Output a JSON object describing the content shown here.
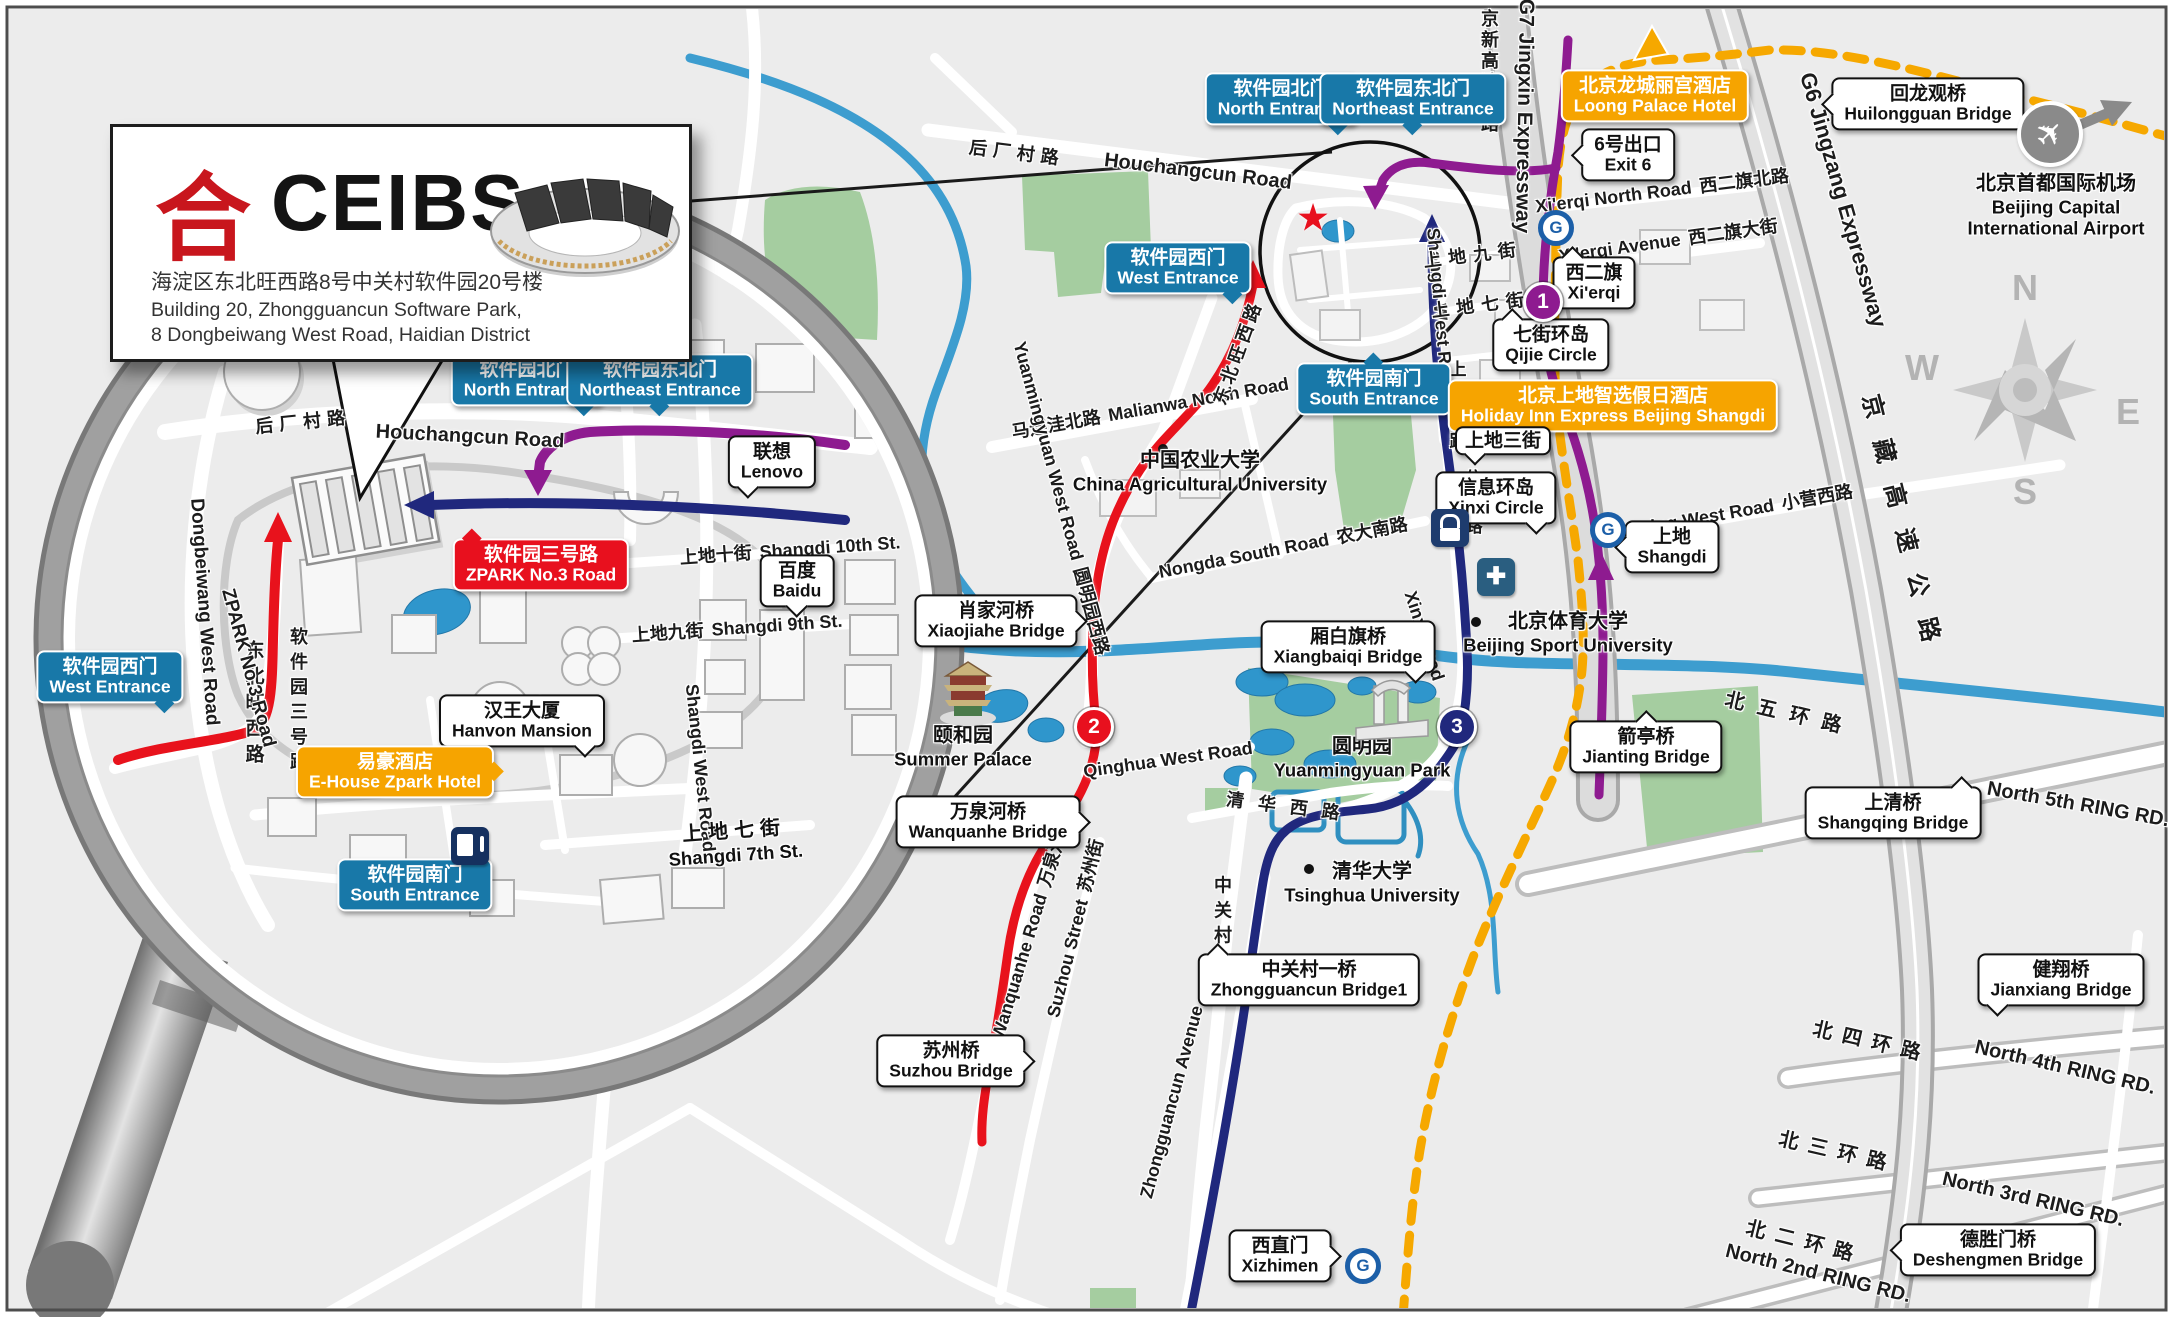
{
  "ceibs": {
    "logo_glyph": "合",
    "name": "CEIBS",
    "address_zh": "海淀区东北旺西路8号中关村软件园20号楼",
    "address_en1": "Building 20, Zhongguancun Software Park,",
    "address_en2": "8 Dongbeiwang West Road, Haidian District"
  },
  "entrances": {
    "north": {
      "zh": "软件园北门",
      "en": "North Entrance"
    },
    "northeast": {
      "zh": "软件园东北门",
      "en": "Northeast Entrance"
    },
    "west": {
      "zh": "软件园西门",
      "en": "West Entrance"
    },
    "south": {
      "zh": "软件园南门",
      "en": "South Entrance"
    }
  },
  "zpark_sign": {
    "zh": "软件园三号路",
    "en": "ZPARK No.3 Road"
  },
  "mag_places": {
    "lenovo": {
      "zh": "联想",
      "en": "Lenovo"
    },
    "baidu": {
      "zh": "百度",
      "en": "Baidu"
    },
    "hanvon": {
      "zh": "汉王大厦",
      "en": "Hanvon Mansion"
    },
    "ehouse": {
      "zh": "易豪酒店",
      "en": "E-House Zpark Hotel"
    }
  },
  "mag_roads": {
    "houchangcun": {
      "zh": "后厂村路",
      "en": "Houchangcun Road"
    },
    "dongbeiwang": {
      "en": "Dongbeiwang West Road",
      "zh": "东北旺西路"
    },
    "zpark3": {
      "en": "ZPARK No.3 Road",
      "zh": "软件园三号路"
    },
    "shangdi10": {
      "zh": "上地十街",
      "en": "Shangdi 10th St."
    },
    "shangdi9": {
      "zh": "上地九街",
      "en": "Shangdi 9th St."
    },
    "shangdi7": {
      "zh": "上地七街",
      "en": "Shangdi 7th St."
    },
    "shangdi_west": {
      "en": "Shangdi West Road"
    }
  },
  "hotels": {
    "loong": {
      "zh": "北京龙城丽宫酒店",
      "en": "Loong Palace Hotel"
    },
    "holiday": {
      "zh": "北京上地智选假日酒店",
      "en": "Holiday Inn Express Beijing Shangdi"
    }
  },
  "callouts": {
    "exit6": {
      "zh": "6号出口",
      "en": "Exit 6"
    },
    "xierqi": {
      "zh": "西二旗",
      "en": "Xi'erqi"
    },
    "qijie": {
      "zh": "七街环岛",
      "en": "Qijie Circle"
    },
    "xinxi": {
      "zh": "信息环岛",
      "en": "Xinxi Circle"
    },
    "shangdi_stn": {
      "zh": "上地",
      "en": "Shangdi"
    },
    "huilongguan": {
      "zh": "回龙观桥",
      "en": "Huilongguan Bridge"
    },
    "xiaojiahe": {
      "zh": "肖家河桥",
      "en": "Xiaojiahe Bridge"
    },
    "xiangbaiqi": {
      "zh": "厢白旗桥",
      "en": "Xiangbaiqi Bridge"
    },
    "wanquanhe": {
      "zh": "万泉河桥",
      "en": "Wanquanhe Bridge"
    },
    "suzhou": {
      "zh": "苏州桥",
      "en": "Suzhou Bridge"
    },
    "jianting": {
      "zh": "箭亭桥",
      "en": "Jianting Bridge"
    },
    "shangqing": {
      "zh": "上清桥",
      "en": "Shangqing Bridge"
    },
    "zgc1": {
      "zh": "中关村一桥",
      "en": "Zhongguancun Bridge1"
    },
    "xizhimen": {
      "zh": "西直门",
      "en": "Xizhimen"
    },
    "jianxiang": {
      "zh": "健翔桥",
      "en": "Jianxiang Bridge"
    },
    "deshengmen": {
      "zh": "德胜门桥",
      "en": "Deshengmen Bridge"
    },
    "shangdi3": {
      "zh": "上地三街"
    }
  },
  "landmarks": {
    "cau": {
      "zh": "中国农业大学",
      "en": "China Agricultural University"
    },
    "bsu": {
      "zh": "北京体育大学",
      "en": "Beijing Sport University"
    },
    "tsinghua": {
      "zh": "清华大学",
      "en": "Tsinghua University"
    },
    "summer": {
      "zh": "颐和园",
      "en": "Summer Palace"
    },
    "ymy": {
      "zh": "圆明园",
      "en": "Yuanmingyuan Park"
    },
    "airport": {
      "zh": "北京首都国际机场",
      "en1": "Beijing Capital",
      "en2": "International Airport"
    }
  },
  "roads": {
    "houchangcun": {
      "zh": "后厂村路",
      "en": "Houchangcun Road"
    },
    "malianwa": {
      "zh": "马连洼北路",
      "en": "Malianwa North Road"
    },
    "dongbeiwang": {
      "zh": "东北旺西路"
    },
    "ymy_west": {
      "en": "Yuanmingyuan West Road",
      "zh": "圆明园西路"
    },
    "nongda": {
      "en": "Nongda South Road",
      "zh": "农大南路"
    },
    "qinghua_w": {
      "en": "Qinghua West Road"
    },
    "qinghua_w_zh": {
      "zh": "清华西路"
    },
    "wanquanhe": {
      "en": "Wanquanhe Road",
      "zh": "万泉河路"
    },
    "suzhou_st": {
      "en": "Suzhou Street",
      "zh": "苏州街"
    },
    "zgc_st": {
      "zh": "中关村大街"
    },
    "zgc_ave": {
      "en": "Zhongguancun Avenue"
    },
    "xinxi_rd": {
      "en": "Xinxi Road",
      "zh": "信息路"
    },
    "shangdi_w": {
      "en": "Shangdi West Road",
      "zh": "上地西路"
    },
    "shangdi9": {
      "zh": "上地九街"
    },
    "shangdi7": {
      "zh": "上地七街"
    },
    "xierqi_n": {
      "en": "Xi'erqi North Road",
      "zh": "西二旗北路"
    },
    "xierqi_ave": {
      "en": "Xi'erqi Avenue",
      "zh": "西二旗大街"
    },
    "xiaoying": {
      "en": "Xiaoying West Road",
      "zh": "小营西路"
    }
  },
  "expressways": {
    "g7": {
      "en": "G7 Jingxin Expressway",
      "zh": "京新高速公路"
    },
    "g6": {
      "en": "G6 Jingzang Expressway",
      "zh": "京藏高速公路"
    }
  },
  "rings": {
    "r5": {
      "zh": "北五环路",
      "en": "North 5th RING RD."
    },
    "r4": {
      "zh": "北四环路",
      "en": "North 4th RING RD."
    },
    "r3": {
      "zh": "北三环路",
      "en": "North 3rd RING RD."
    },
    "r2": {
      "zh": "北二环路",
      "en": "North 2nd RING RD."
    }
  },
  "markers": {
    "one": "1",
    "two": "2",
    "three": "3"
  },
  "compass": {
    "n": "N",
    "e": "E",
    "s": "S",
    "w": "W"
  },
  "icons": {
    "subway_logo": "G",
    "hospital_cross": "✚",
    "red_star": "★",
    "airplane": "✈"
  },
  "colors": {
    "route_red": "#e8121c",
    "route_blue": "#20287d",
    "route_purple": "#8e1b90",
    "subway_line13_orange": "#f6a800",
    "label_blue": "#1878a8",
    "label_orange": "#f6a400",
    "label_red": "#e8101e",
    "water": "#3d9dcf",
    "green": "#a5cda0"
  }
}
